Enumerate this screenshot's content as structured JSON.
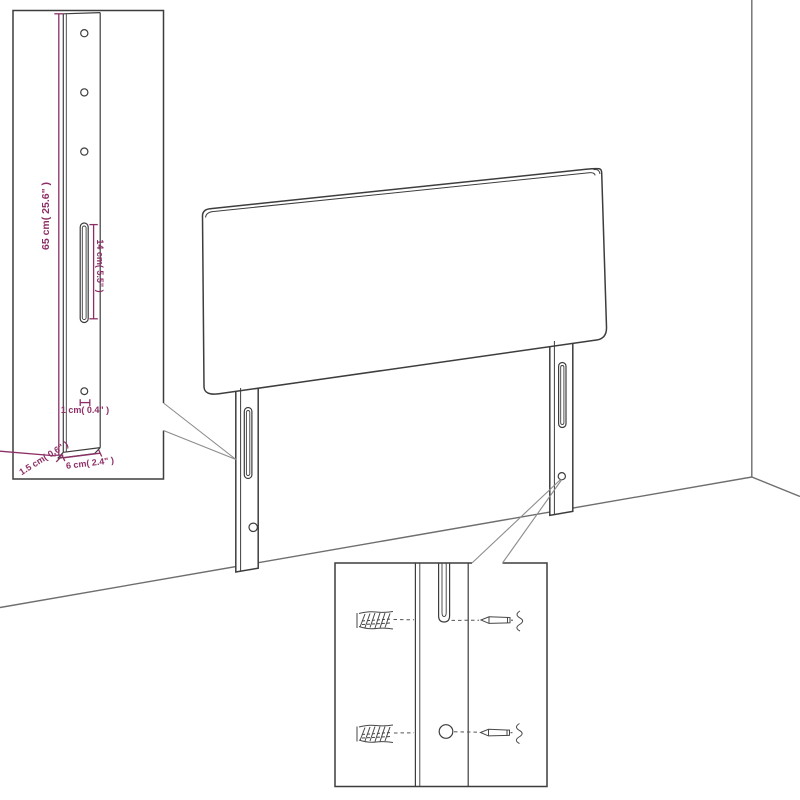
{
  "diagram": {
    "title": "headboard wall-mounting dimension diagram",
    "colors": {
      "dimension_text": "#8d2f66",
      "drawing_line": "#3d3d3d",
      "wall_line": "#6e6e6e",
      "background": "#ffffff"
    },
    "leg_detail_inset": {
      "height_label": "65 cm( 25.6\" )",
      "slot_label": "14 cm( 5.5\" )",
      "hole_label": "1 cm( 0.4\" )",
      "thickness_label": "1.5 cm( 0.6\" )",
      "width_label": "6 cm( 2.4\" )"
    }
  }
}
